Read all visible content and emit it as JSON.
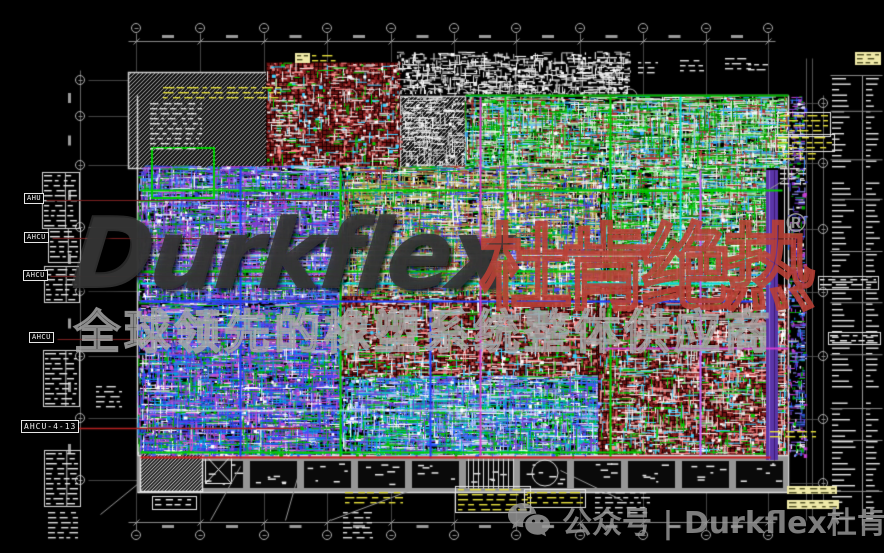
{
  "canvas": {
    "width": 884,
    "height": 553,
    "background": "#000000"
  },
  "watermark": {
    "brand": "Durkflex",
    "registered": "®",
    "brand_cn": "杜肯绝热",
    "tagline_cn": "全球领先的橡塑系统整体供应商",
    "footer_icon": "wechat-icon",
    "footer_text": "公众号 | Durkflex杜肯绝热",
    "colors": {
      "brand": "#343434",
      "brand_cn": "#ba4036",
      "tagline": "#a8a8a8",
      "footer": "#989898"
    }
  },
  "equipment_labels": [
    {
      "text": "AHU",
      "x": 24,
      "y": 193
    },
    {
      "text": "AHCU",
      "x": 24,
      "y": 232
    },
    {
      "text": "AHCU",
      "x": 23,
      "y": 270
    },
    {
      "text": "AHCU",
      "x": 29,
      "y": 332
    },
    {
      "text": "AHCU-4-13",
      "x": 21,
      "y": 420
    }
  ],
  "drawing_colors": {
    "dimension_lines": "#8a8a8a",
    "grid_bubbles": "#b4b4b4",
    "plan_walls": "#d6d6d6",
    "hatch_gray": "#b4b4b4",
    "brick_red_base": "#6b1111",
    "brick_red_light": "#c25050",
    "corridor_gray": "#969696",
    "annotation_yellow": "#e8e23c",
    "annotation_pale_yellow": "#efe9a8",
    "leader_red": "#7a2020",
    "leader_red_bright": "#b42020",
    "purple_band": "#5a35a8",
    "palettes": {
      "greenHeavy": [
        "#00c800",
        "#008a00",
        "#ffffff",
        "#9be89b",
        "#30b0ff",
        "#b43232",
        "#d8d8d8"
      ],
      "purpleBlue": [
        "#3a3ad8",
        "#7a3fd0",
        "#c040d0",
        "#2f86ff",
        "#ffffff",
        "#00a800",
        "#9a9aff"
      ],
      "mixedTan": [
        "#cdbb66",
        "#a89a3c",
        "#00b400",
        "#a83232",
        "#ffffff",
        "#4646ff",
        "#e2e2e2",
        "#00a0a0"
      ],
      "bluePurple": [
        "#2842e6",
        "#4646ff",
        "#8a46cc",
        "#00a2e2",
        "#ffffff",
        "#00b400",
        "#d050d0"
      ],
      "blueGreen": [
        "#2a62ff",
        "#00c2c2",
        "#00c200",
        "#ffffff",
        "#aab4ff",
        "#7a3fd0"
      ],
      "brickSparse": [
        "#ffffff",
        "#00c800",
        "#e0e0e0",
        "#ff9090",
        "#40d0ff"
      ],
      "whiteSparse": [
        "#e8e8e8",
        "#ffffff",
        "#bdbdbd"
      ]
    }
  },
  "grid": {
    "top_bubble_xs": [
      136,
      200,
      264,
      327,
      391,
      454,
      516,
      580,
      643,
      706,
      768
    ],
    "top_bubble_y": 28,
    "bottom_bubble_y": 535,
    "left_bubble_x": 80,
    "left_bubble_ys": [
      80,
      116,
      165,
      227,
      291,
      356,
      418,
      480
    ],
    "right_bubble_x": 823,
    "right_bubble_ys": [
      103,
      163,
      229,
      292,
      356,
      419,
      483
    ]
  }
}
